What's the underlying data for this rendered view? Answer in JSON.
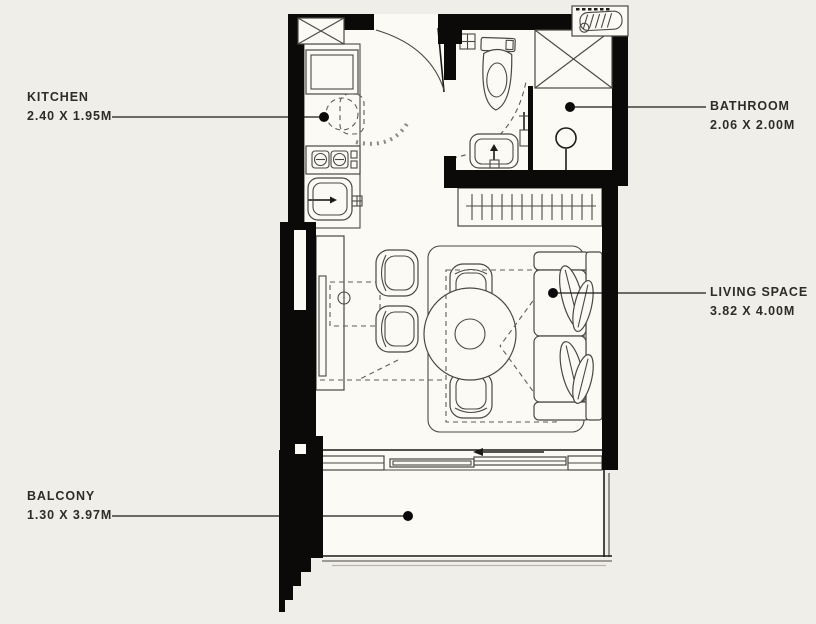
{
  "rooms": {
    "kitchen": {
      "label": "KITCHEN",
      "dimensions": "2.40 X 1.95M"
    },
    "bathroom": {
      "label": "BATHROOM",
      "dimensions": "2.06 X 2.00M"
    },
    "living_space": {
      "label": "LIVING SPACE",
      "dimensions": "3.82 X 4.00M"
    },
    "balcony": {
      "label": "BALCONY",
      "dimensions": "1.30 X 3.97M"
    }
  },
  "fixtures": [
    "entry-door",
    "refrigerator",
    "stove",
    "kitchen-sink",
    "service-shaft",
    "ac-unit",
    "toilet",
    "bathroom-sink",
    "shower",
    "glass-partition",
    "wardrobe-rail",
    "tv-cabinet",
    "dining-table",
    "chairs",
    "rug",
    "sofa",
    "fold-down-bed",
    "sliding-balcony-door",
    "balcony-railing"
  ],
  "colors": {
    "background": "#f0eee8",
    "floor": "#fbfaf5",
    "wall": "#0b0a08",
    "line": "#4a4842",
    "ink": "#1c1b17",
    "label": "#2e2c27"
  }
}
